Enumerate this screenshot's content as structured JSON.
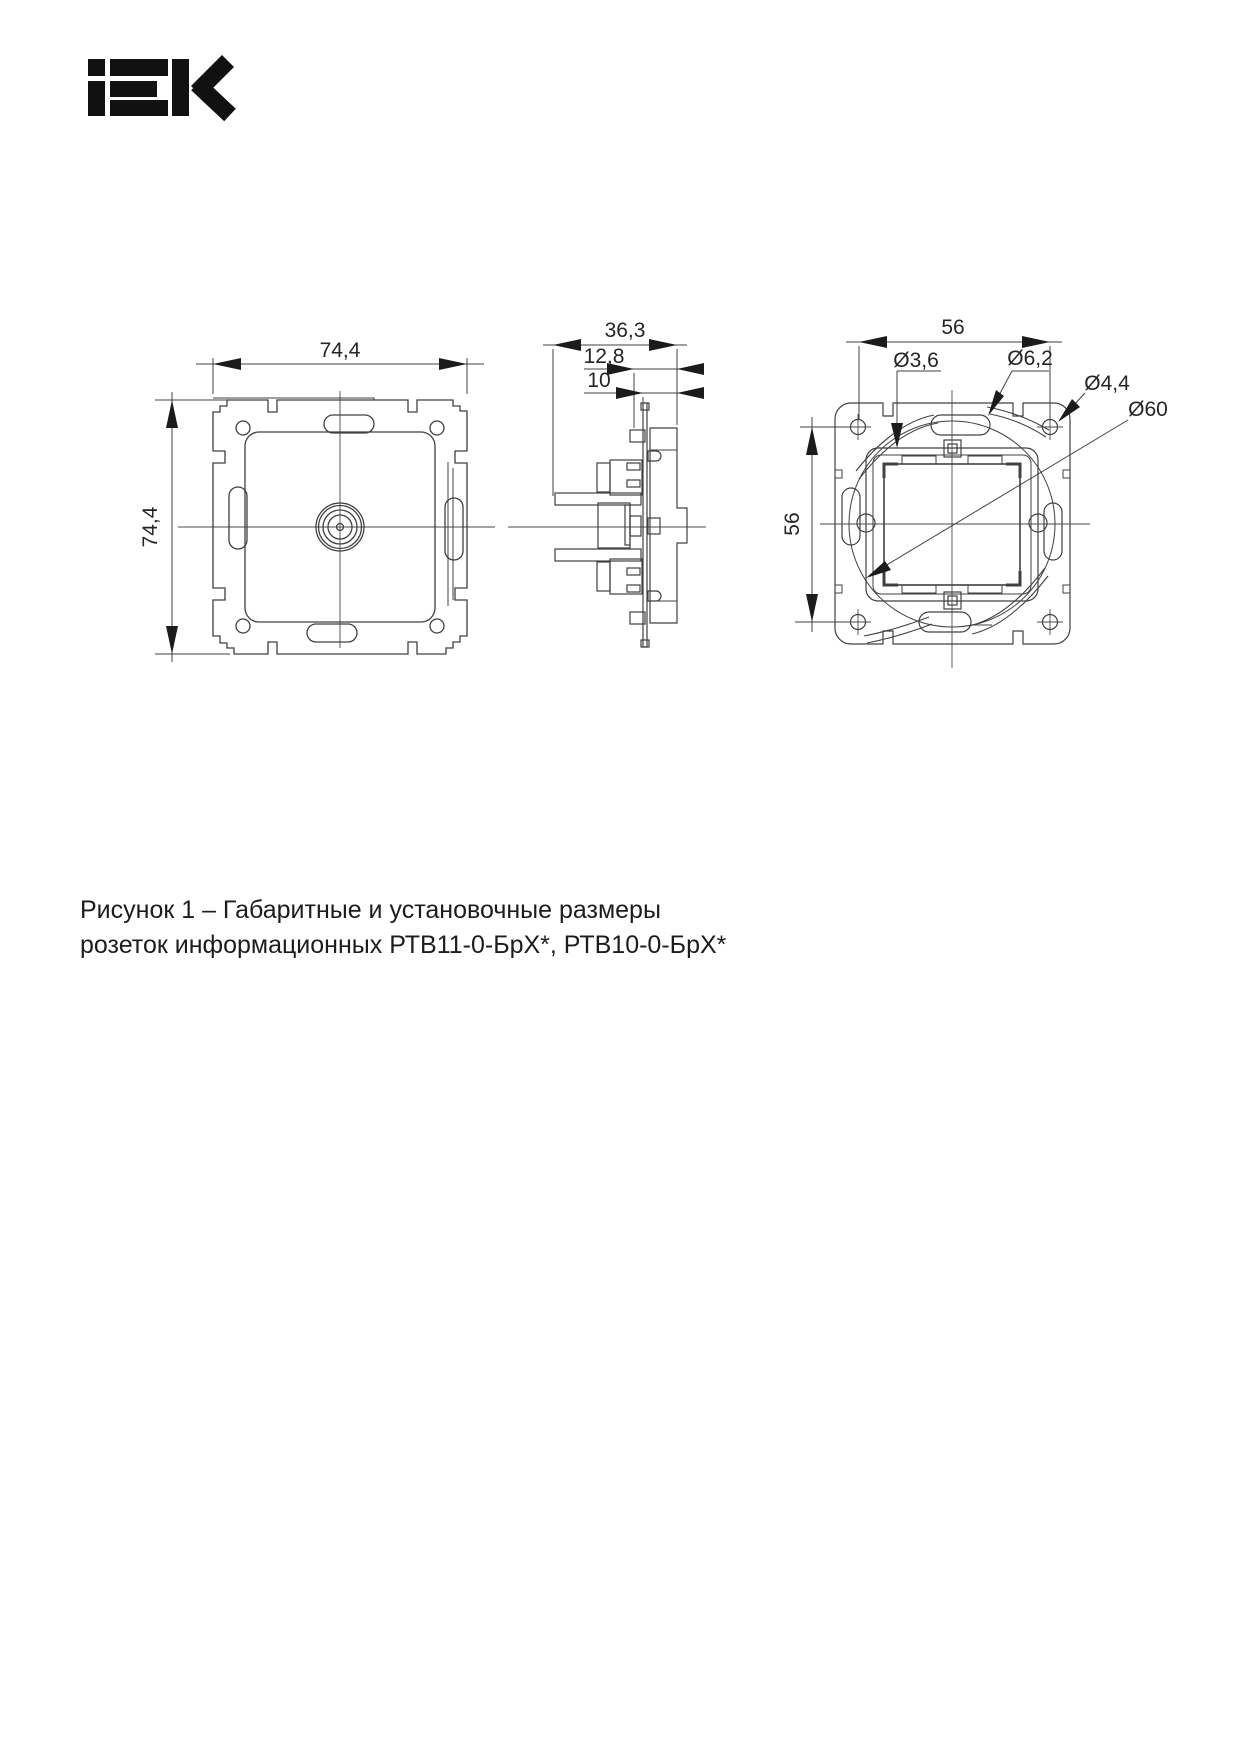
{
  "logo": {
    "brand": "IEK"
  },
  "drawing": {
    "front": {
      "dim_width": "74,4",
      "dim_height": "74,4"
    },
    "side": {
      "dim_depth": "36,3",
      "dim_mid": "12,8",
      "dim_front": "10"
    },
    "back": {
      "dim_width": "56",
      "dim_height": "56",
      "dia_screw": "Ø3,6",
      "dia_slot": "Ø6,2",
      "dia_hole": "Ø4,4",
      "dia_circle": "Ø60"
    }
  },
  "caption": {
    "line1": "Рисунок 1 – Габаритные и установочные размеры",
    "line2": "розеток информационных РТВ11-0-БрХ*, РТВ10-0-БрХ*"
  },
  "colors": {
    "line": "#404040",
    "text": "#252525",
    "ink": "#111111"
  }
}
